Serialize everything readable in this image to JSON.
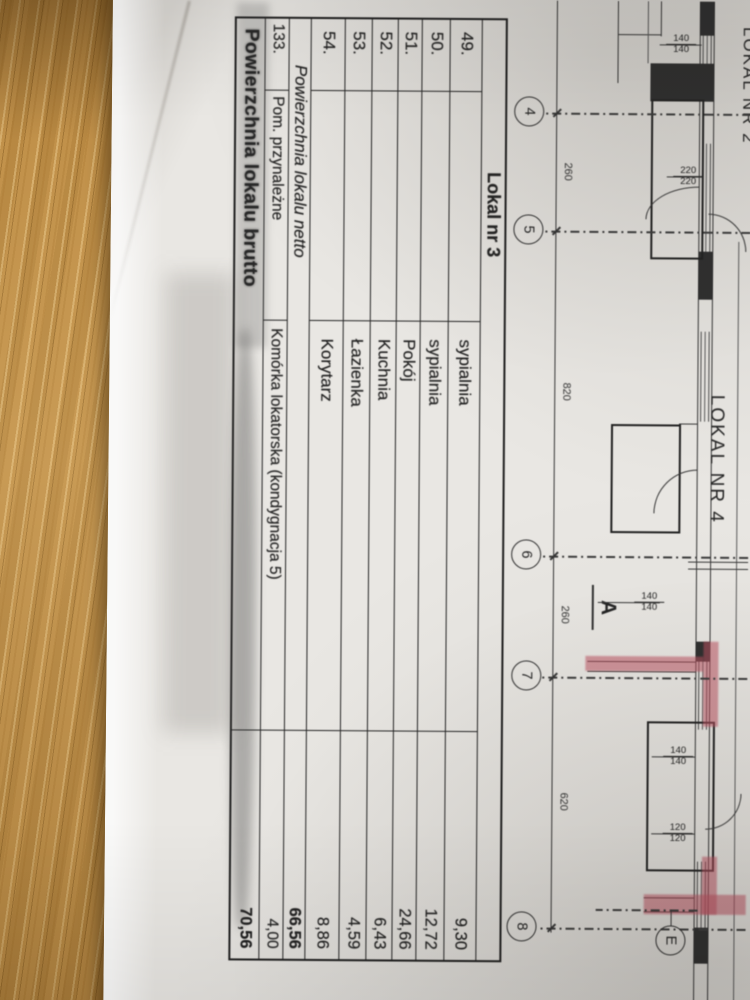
{
  "table": {
    "header": "Lokal nr 3",
    "rows": [
      {
        "no": "49.",
        "name": "sypialnia",
        "value": "9,30"
      },
      {
        "no": "50.",
        "name": "sypialnia",
        "value": "12,72"
      },
      {
        "no": "51.",
        "name": "Pokój",
        "value": "24,66"
      },
      {
        "no": "52.",
        "name": "Kuchnia",
        "value": "6,43"
      },
      {
        "no": "53.",
        "name": "Łazienka",
        "value": "4,59"
      },
      {
        "no": "54.",
        "name": "Korytarz",
        "value": "8,86"
      }
    ],
    "netto": {
      "label": "Powierzchnia lokalu netto",
      "value": "66,56"
    },
    "annex": {
      "no": "133.",
      "label": "Pom. przynależne",
      "name": "Komórka lokatorska (kondygnacja 5)",
      "value": "4,00"
    },
    "brutto": {
      "label": "Powierzchnia lokalu brutto",
      "value": "70,56"
    }
  },
  "plan": {
    "apartments": [
      "LOKAL NR 2",
      "LOKAL NR 4"
    ],
    "section_marker": "A",
    "grid_bubbles": [
      "4",
      "5",
      "6",
      "7",
      "8"
    ],
    "grid_letter": "E",
    "main_dims": [
      "260",
      "820",
      "260",
      "620"
    ],
    "window_dims": {
      "w140": "140",
      "w220": "220",
      "w120": "120"
    }
  },
  "colors": {
    "wood": "#c1914a",
    "paper": "#e9e7e3",
    "ink": "#1e1e1e",
    "red": "#bb4f5e"
  }
}
